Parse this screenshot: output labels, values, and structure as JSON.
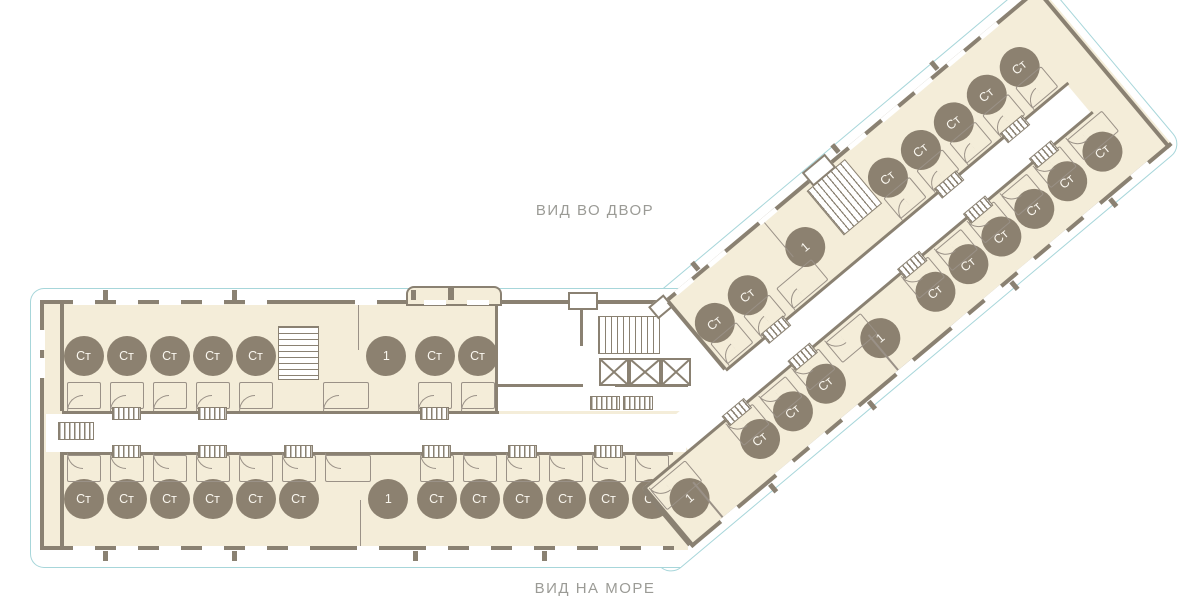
{
  "view_labels": {
    "courtyard": "ВИД ВО ДВОР",
    "sea": "ВИД НА МОРЕ"
  },
  "apartment_types": {
    "studio": "Ст",
    "one_room": "1"
  },
  "colors": {
    "room_fill": "#f4edd9",
    "wall": "#8a8172",
    "badge_fill": "#8c8170",
    "badge_text": "#faf7ef",
    "outline": "#a7d6da",
    "corridor": "#ffffff",
    "thin_line": "#9a9187",
    "view_label_text": "#9b9b96"
  },
  "wings": {
    "main": {
      "top_row": [
        {
          "type": "studio",
          "label": "Ст"
        },
        {
          "type": "studio",
          "label": "Ст"
        },
        {
          "type": "studio",
          "label": "Ст"
        },
        {
          "type": "studio",
          "label": "Ст"
        },
        {
          "type": "studio",
          "label": "Ст"
        },
        {
          "type": "stairs"
        },
        {
          "type": "one",
          "label": "1"
        },
        {
          "type": "studio",
          "label": "Ст"
        },
        {
          "type": "studio",
          "label": "Ст"
        }
      ],
      "bottom_row": [
        {
          "type": "studio",
          "label": "Ст"
        },
        {
          "type": "studio",
          "label": "Ст"
        },
        {
          "type": "studio",
          "label": "Ст"
        },
        {
          "type": "studio",
          "label": "Ст"
        },
        {
          "type": "studio",
          "label": "Ст"
        },
        {
          "type": "studio",
          "label": "Ст"
        },
        {
          "type": "one",
          "label": "1"
        },
        {
          "type": "studio",
          "label": "Ст"
        },
        {
          "type": "studio",
          "label": "Ст"
        },
        {
          "type": "studio",
          "label": "Ст"
        },
        {
          "type": "studio",
          "label": "Ст"
        },
        {
          "type": "studio",
          "label": "Ст"
        },
        {
          "type": "studio",
          "label": "Ст"
        }
      ]
    },
    "diagonal": {
      "upper_row": [
        {
          "type": "studio",
          "label": "Ст"
        },
        {
          "type": "studio",
          "label": "Ст"
        },
        {
          "type": "one",
          "label": "1"
        },
        {
          "type": "stairs"
        },
        {
          "type": "studio",
          "label": "Ст"
        },
        {
          "type": "studio",
          "label": "Ст"
        },
        {
          "type": "studio",
          "label": "Ст"
        },
        {
          "type": "studio",
          "label": "Ст"
        },
        {
          "type": "studio",
          "label": "Ст"
        }
      ],
      "lower_row": [
        {
          "type": "one",
          "label": "1"
        },
        {
          "type": "studio",
          "label": "Ст"
        },
        {
          "type": "studio",
          "label": "Ст"
        },
        {
          "type": "studio",
          "label": "Ст"
        },
        {
          "type": "one",
          "label": "1"
        },
        {
          "type": "studio",
          "label": "Ст"
        },
        {
          "type": "studio",
          "label": "Ст"
        },
        {
          "type": "studio",
          "label": "Ст"
        },
        {
          "type": "studio",
          "label": "Ст"
        },
        {
          "type": "studio",
          "label": "Ст"
        },
        {
          "type": "end_studio",
          "label": "Ст"
        }
      ]
    }
  }
}
